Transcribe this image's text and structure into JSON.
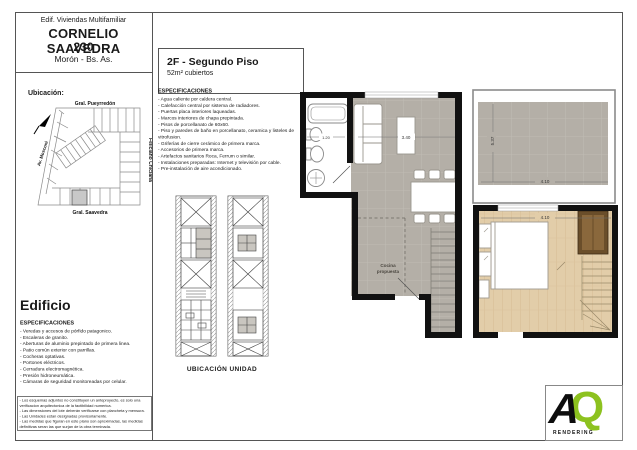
{
  "sheet": {
    "header": {
      "building_type": "Edif. Viviendas Multifamiliar",
      "name": "CORNELIO SAAVEDRA",
      "number": "230",
      "city": "Morón - Bs. As."
    },
    "location": {
      "label": "Ubicación:",
      "street_top": "Gral. Pueyrredón",
      "street_left": "Av. Mosconi",
      "street_right": "Feliciano Chiclana",
      "street_bottom": "Gral. Saavedra"
    },
    "unit": {
      "title": "2F - Segundo Piso",
      "area": "52m² cubiertos",
      "specs_heading": "ESPECIFICACIONES",
      "specs": [
        "- Agua caliente por caldera central.",
        "- Calefacción central por sistema de radiadores.",
        "- Puertas placa interiores laqueadas.",
        "- Marcos interiores de chapa prepintada.",
        "- Pisos de porcellanato de 60x60.",
        "- Piso y paredes de baño en porcellanato, ceramica y listeles de vitrofusion.",
        "- Griferías de cierre cerámico de primera marca.",
        "- Accesorios de primera marca.",
        "- Artefactos sanitarios Roca, Ferrum o similar.",
        "- Instalaciones preparadas: Internet y televisión por cable.",
        "- Pre-instalación de aire acondicionado."
      ]
    },
    "building": {
      "title": "Edificio",
      "specs_heading": "ESPECIFICACIONES",
      "specs": [
        "- Veredas y accesos de pórfido patagonico.",
        "- Escaleras de granito.",
        "- Aberturas de aluminio prepintado de primera linea.",
        "- Patio común exterior con parrillas.",
        "- Cocheras optativas.",
        "- Portones eléctricos.",
        "- Cerradura electromagnética.",
        "- Presión hidroneumática.",
        "- Cámaras de seguridad monitoreadas por celular."
      ]
    },
    "notes": [
      "- Los esquemas adjuntos no constituyen un anteproyecto, es solo una verificacion arquitectonica de la factibilidad numerica.",
      "- Las dimensiones del lote deberán verificarse con plancheta y mensura.",
      "- Las Unidades estan designadas provisoriamente.",
      "- Las medidas que figuran en este plano son aproximadas, las medidas definitivas seran las que surjan de la obra terminada."
    ],
    "key_plan_label": "UBICACIÓN UNIDAD",
    "plan": {
      "kitchen_note_line1": "Cocina",
      "kitchen_note_line2": "propuesta",
      "dim_island": "3.40",
      "dim_bath": "1.20",
      "dim_terrace_width": "4.10",
      "dim_terrace_height": "5.37",
      "dim_bedroom_width": "4.10"
    },
    "logo": {
      "a": "A",
      "q": "Q",
      "caption": "RENDERING"
    },
    "colors": {
      "logo_green": "#8dc21f",
      "wall": "#111111",
      "floor_tile": "#b4afa7",
      "floor_wood": "#e2cda9",
      "highlight_lot": "#c8c8c8"
    }
  }
}
